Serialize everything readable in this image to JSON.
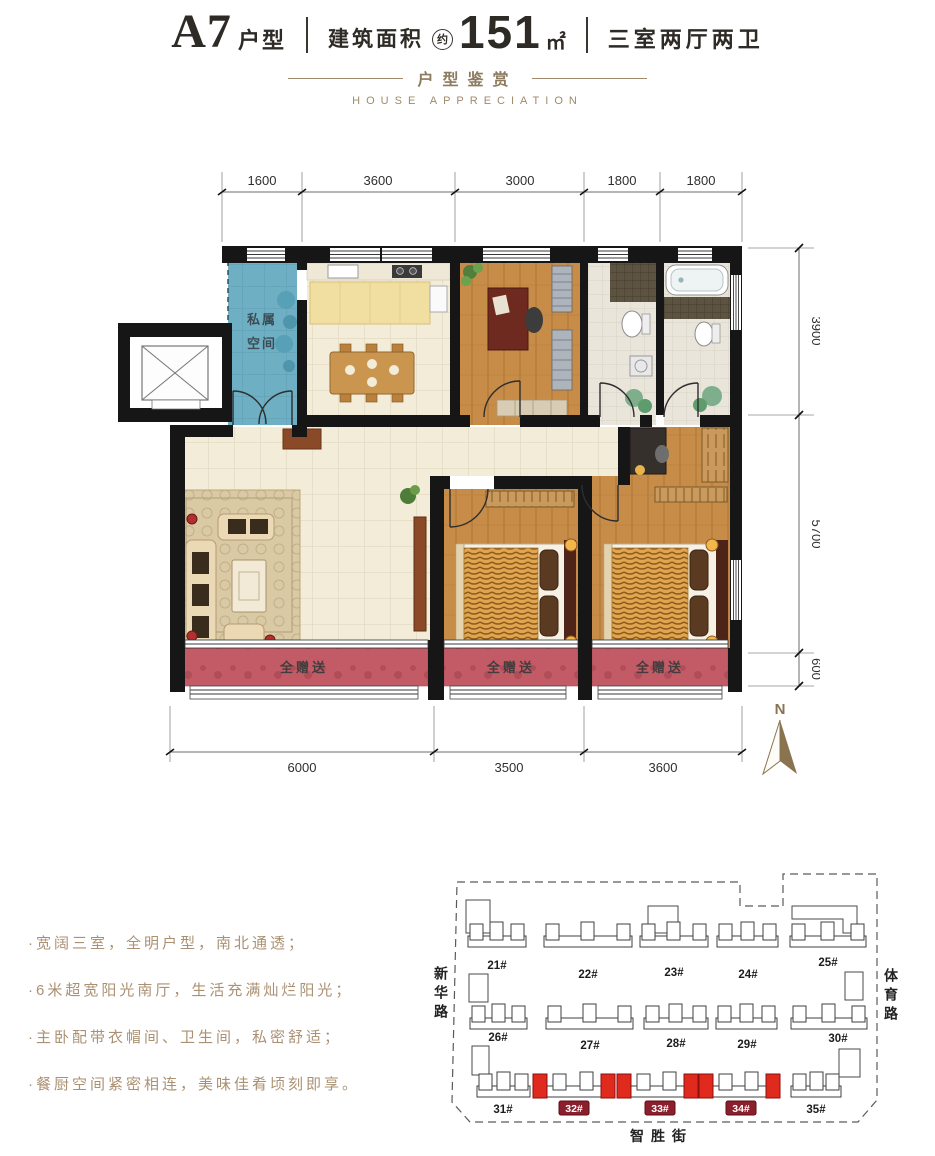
{
  "header": {
    "unit_code": "A7",
    "unit_type_label": "户型",
    "area_label": "建筑面积",
    "area_approx_badge": "约",
    "area_value": "151",
    "area_unit": "㎡",
    "rooms_summary": "三室两厅两卫"
  },
  "subtitle": {
    "cn": "户型鉴赏",
    "en": "HOUSE APPRECIATION"
  },
  "floorplan": {
    "dims_top": [
      "1600",
      "3600",
      "3000",
      "1800",
      "1800"
    ],
    "dims_right": [
      "3900",
      "5700",
      "600"
    ],
    "dims_bottom": [
      "6000",
      "3500",
      "3600"
    ],
    "labels": {
      "private_space_line1": "私属",
      "private_space_line2": "空间",
      "balcony_bonus": "全赠送"
    },
    "north_label": "N"
  },
  "features": [
    "·宽阔三室，全明户型，南北通透；",
    "·6米超宽阳光南厅，生活充满灿烂阳光；",
    "·主卧配带衣帽间、卫生间，私密舒适；",
    "·餐厨空间紧密相连，美味佳肴顷刻即享。"
  ],
  "siteplan": {
    "roads": {
      "left": "新华路",
      "right": "体育路",
      "bottom": "智胜街"
    },
    "buildings": [
      "21#",
      "22#",
      "23#",
      "24#",
      "25#",
      "26#",
      "27#",
      "28#",
      "29#",
      "30#",
      "31#",
      "32#",
      "33#",
      "34#",
      "35#"
    ],
    "highlighted_buildings": [
      "32#",
      "33#",
      "34#"
    ]
  },
  "colors": {
    "accent_tan": "#a08a6a",
    "feature_text": "#ab9173",
    "wall": "#161616",
    "private_teal": "#6fafc3",
    "balcony_rose": "#c25b66",
    "wood": "#c68c48",
    "kitchen_counter": "#f0dfa0",
    "highlight_red": "#e02a1e",
    "label_maroon": "#8c1f2d",
    "north_arrow": "#8a744f"
  }
}
